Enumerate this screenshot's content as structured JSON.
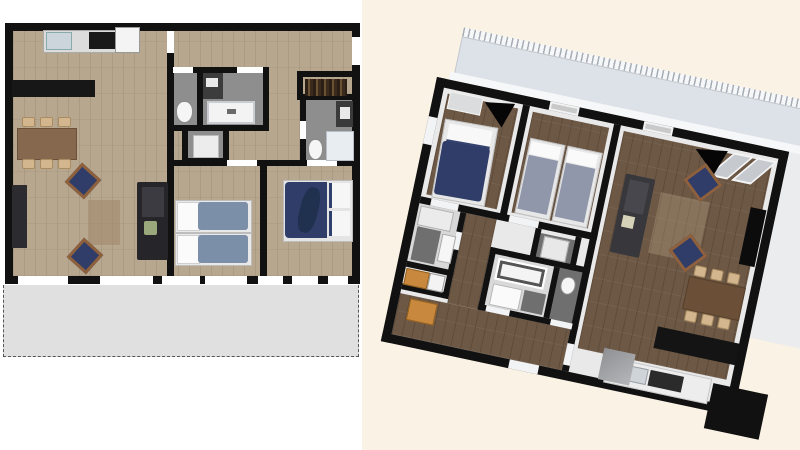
{
  "scene": {
    "type": "apartment-floor-plan-render-comparison",
    "left_view": "2d-top-down-plan",
    "right_view": "3d-tilted-top-view",
    "right_view_tilt_deg": 12,
    "visible_text": ""
  },
  "colors": {
    "wall": "#111111",
    "wood_light": "#b7a78f",
    "wood_dark": "#6d5845",
    "tile_gray": "#8e8e8e",
    "tile_dark": "#6f6f6f",
    "balcony_gray": "#e0e0e0",
    "cream_bg": "#faf2e4",
    "terrace_blue": "#dde2e8",
    "navy": "#2f3d68",
    "bed_blue": "#7b8fa9",
    "bed_gray": "#9097ab",
    "sofa_dark": "#26262a",
    "table_brown": "#85684d",
    "table_brown_dark": "#6b4f37",
    "chair_tan": "#d3b68e",
    "orange_cabinet": "#c8883e"
  },
  "left_plan": {
    "rooms": [
      "living-dining-kitchen",
      "hall",
      "wc",
      "bathroom",
      "shower-room",
      "wardrobe",
      "ensuite-bathroom",
      "twin-bedroom",
      "double-bedroom",
      "balcony"
    ],
    "furniture": [
      "kitchen-counter",
      "sink",
      "stove",
      "fridge",
      "kitchen-island",
      "dining-table",
      "six-dining-chairs",
      "tv-sideboard",
      "sofa",
      "two-armchairs",
      "rug",
      "two-single-beds",
      "double-bed",
      "toilets",
      "bathtub",
      "vanity",
      "showers",
      "clothes-rail"
    ]
  },
  "right_plan": {
    "rooms": [
      "double-bedroom",
      "twin-bedroom",
      "living-dining-room",
      "kitchen",
      "hall",
      "bathroom",
      "wc",
      "shower-room",
      "ensuite-bathroom",
      "wardrobe",
      "terrace"
    ],
    "furniture": [
      "double-bed",
      "two-single-beds",
      "closet",
      "open-doors",
      "sofa",
      "two-armchairs",
      "rug",
      "tv-cabinet",
      "dining-table",
      "six-dining-chairs",
      "black-sideboard",
      "kitchen-counter",
      "fridge",
      "washer",
      "wardrobe-cabinet",
      "hall-cabinet",
      "bathtub",
      "toilets",
      "showers",
      "window-glass-panes"
    ]
  }
}
